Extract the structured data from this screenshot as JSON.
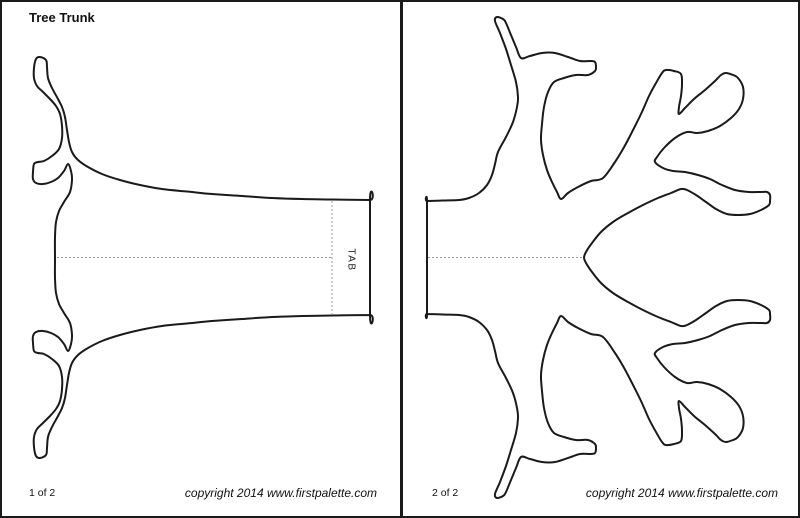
{
  "document": {
    "title": "Tree Trunk"
  },
  "pages": [
    {
      "name": "tree-trunk-template",
      "page_label": "1 of 2",
      "copyright": "copyright 2014 www.firstpalette.com",
      "tab_label": "TAB"
    },
    {
      "name": "tree-branches-template",
      "page_label": "2 of 2",
      "copyright": "copyright 2014 www.firstpalette.com"
    }
  ],
  "colors": {
    "outline": "#1a1a1a",
    "fold_line": "#9a9a9a",
    "page_background": "#ffffff",
    "border": "#000000"
  }
}
